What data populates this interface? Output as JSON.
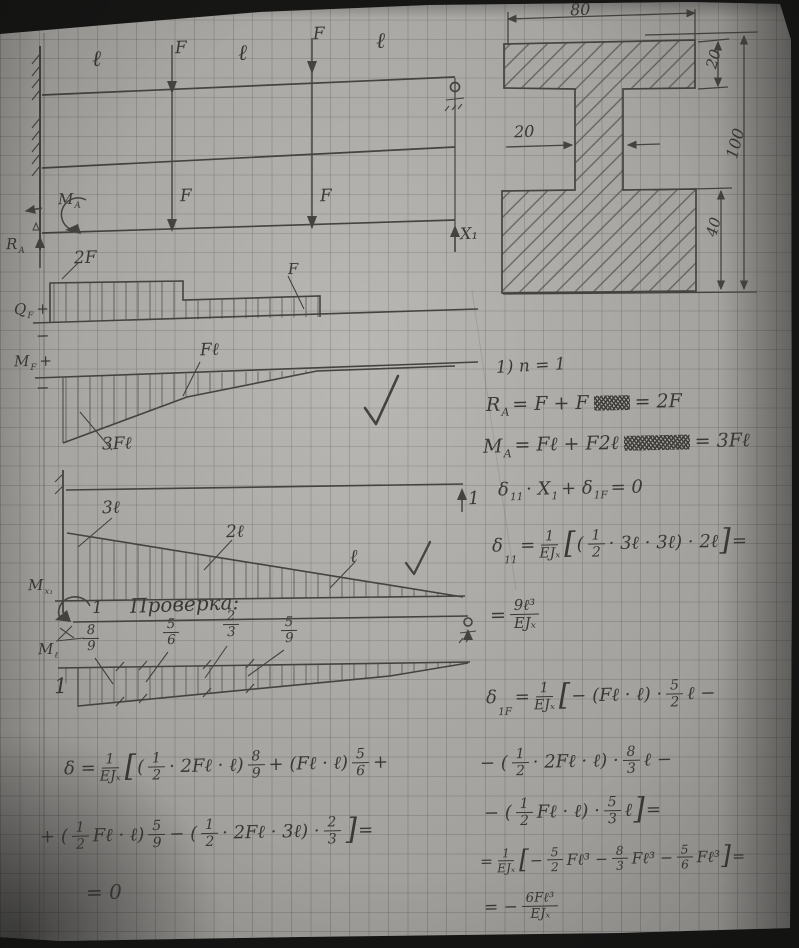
{
  "cross_section": {
    "dim_width": "80",
    "dim_flange_top": "20",
    "dim_web": "20",
    "dim_height": "100",
    "dim_flange_bottom": "40"
  },
  "beam1": {
    "seg1": "ℓ",
    "force1": "F",
    "seg2": "ℓ",
    "force2": "F",
    "seg3": "ℓ"
  },
  "beam2": {
    "moment_label": [
      {
        "v": "M"
      },
      {
        "v": "A",
        "c": "sub"
      }
    ],
    "reaction_label": [
      {
        "v": "R"
      },
      {
        "v": "A",
        "c": "sub"
      }
    ],
    "force1": "F",
    "force2": "F",
    "redundant": "X₁"
  },
  "shear_diagram": {
    "axis_label": [
      {
        "v": "Q"
      },
      {
        "v": "F",
        "c": "sub"
      },
      {
        "v": " +"
      }
    ],
    "minus": "−",
    "value1": "2F",
    "value2": "F"
  },
  "moment_diagram": {
    "axis_label": [
      {
        "v": "M"
      },
      {
        "v": "F",
        "c": "sub"
      },
      {
        "v": " +"
      }
    ],
    "minus": "−",
    "kink_value": "Fℓ",
    "peak_value": "3Fℓ"
  },
  "unit_diagram": {
    "axis_label": [
      {
        "v": "M"
      },
      {
        "v": "x₁",
        "c": "sub"
      }
    ],
    "value1": "3ℓ",
    "value2": "2ℓ",
    "value3": "ℓ",
    "unit_force": "1"
  },
  "check_diagram": {
    "title": "Проверка:",
    "unit_moment": "1",
    "axis_label": [
      {
        "v": "M"
      },
      {
        "v": "ℓ",
        "c": "sub"
      }
    ],
    "left_ordinate": "1",
    "frac1": [
      {
        "n": "8",
        "d": "9"
      }
    ],
    "frac2": [
      {
        "n": "5",
        "d": "6"
      }
    ],
    "frac3": [
      {
        "n": "2",
        "d": "3"
      }
    ],
    "frac4": [
      {
        "n": "5",
        "d": "9"
      }
    ]
  },
  "formulas": {
    "n1": [
      {
        "v": "1) n = 1"
      }
    ],
    "ra": [
      {
        "v": "R"
      },
      {
        "v": "A",
        "c": "sub"
      },
      {
        "v": " = F + F"
      },
      {
        "w": 36,
        "c": "scrib"
      },
      {
        "v": " = 2F"
      }
    ],
    "ma": [
      {
        "v": "M"
      },
      {
        "v": "A",
        "c": "sub"
      },
      {
        "v": " = Fℓ + F2ℓ"
      },
      {
        "w": 66,
        "c": "scrib"
      },
      {
        "v": " = 3Fℓ"
      }
    ],
    "canonical": [
      {
        "v": "δ"
      },
      {
        "v": "11",
        "c": "sub"
      },
      {
        "v": "· X"
      },
      {
        "v": "1",
        "c": "sub"
      },
      {
        "v": " + δ"
      },
      {
        "v": "1F",
        "c": "sub"
      },
      {
        "v": " = 0"
      }
    ],
    "d11": [
      {
        "v": "δ"
      },
      {
        "v": "11",
        "c": "sub"
      },
      {
        "v": " = "
      },
      {
        "n": "1",
        "d": "EJₓ"
      },
      {
        "v": "[",
        "c": "big"
      },
      {
        "v": " ("
      },
      {
        "n": "1",
        "d": "2"
      },
      {
        "v": "· 3ℓ · 3ℓ) · 2ℓ "
      },
      {
        "v": "]",
        "c": "big"
      },
      {
        "v": " ="
      }
    ],
    "d11_result": [
      {
        "v": "= "
      },
      {
        "n": "9ℓ³",
        "d": "EJₓ"
      }
    ],
    "d1f_1": [
      {
        "v": "δ"
      },
      {
        "v": "1F",
        "c": "sub"
      },
      {
        "v": " = "
      },
      {
        "n": "1",
        "d": "EJₓ"
      },
      {
        "v": "[",
        "c": "big"
      },
      {
        "v": "− (Fℓ · ℓ) · "
      },
      {
        "n": "5",
        "d": "2"
      },
      {
        "v": " ℓ −"
      }
    ],
    "d1f_2": [
      {
        "v": "− ("
      },
      {
        "n": "1",
        "d": "2"
      },
      {
        "v": " · 2Fℓ · ℓ) · "
      },
      {
        "n": "8",
        "d": "3"
      },
      {
        "v": " ℓ −"
      }
    ],
    "d1f_3": [
      {
        "v": "− ("
      },
      {
        "n": "1",
        "d": "2"
      },
      {
        "v": " Fℓ · ℓ) · "
      },
      {
        "n": "5",
        "d": "3"
      },
      {
        "v": " ℓ "
      },
      {
        "v": "]",
        "c": "big"
      },
      {
        "v": " ="
      }
    ],
    "d1f_4": [
      {
        "v": "= "
      },
      {
        "n": "1",
        "d": "EJₓ"
      },
      {
        "v": "[",
        "c": "big"
      },
      {
        "v": "− "
      },
      {
        "n": "5",
        "d": "2"
      },
      {
        "v": " Fℓ³ − "
      },
      {
        "n": "8",
        "d": "3"
      },
      {
        "v": " Fℓ³ − "
      },
      {
        "n": "5",
        "d": "6"
      },
      {
        "v": " Fℓ³ "
      },
      {
        "v": "]",
        "c": "big"
      },
      {
        "v": " ="
      }
    ],
    "d1f_result": [
      {
        "v": "= − "
      },
      {
        "n": "6Fℓ³",
        "d": "EJₓ"
      }
    ],
    "check_1": [
      {
        "v": "δ = "
      },
      {
        "n": "1",
        "d": "EJₓ"
      },
      {
        "v": "[",
        "c": "big"
      },
      {
        "v": " ("
      },
      {
        "n": "1",
        "d": "2"
      },
      {
        "v": "· 2Fℓ · ℓ) "
      },
      {
        "n": "8",
        "d": "9"
      },
      {
        "v": " + (Fℓ · ℓ) "
      },
      {
        "n": "5",
        "d": "6"
      },
      {
        "v": " +"
      }
    ],
    "check_2": [
      {
        "v": "+ ("
      },
      {
        "n": "1",
        "d": "2"
      },
      {
        "v": " Fℓ · ℓ) "
      },
      {
        "n": "5",
        "d": "9"
      },
      {
        "v": " − ("
      },
      {
        "n": "1",
        "d": "2"
      },
      {
        "v": " · 2Fℓ · 3ℓ) · "
      },
      {
        "n": "2",
        "d": "3"
      },
      {
        "v": " "
      },
      {
        "v": "]",
        "c": "big"
      },
      {
        "v": " ="
      }
    ],
    "check_3": [
      {
        "v": "= 0"
      }
    ]
  }
}
